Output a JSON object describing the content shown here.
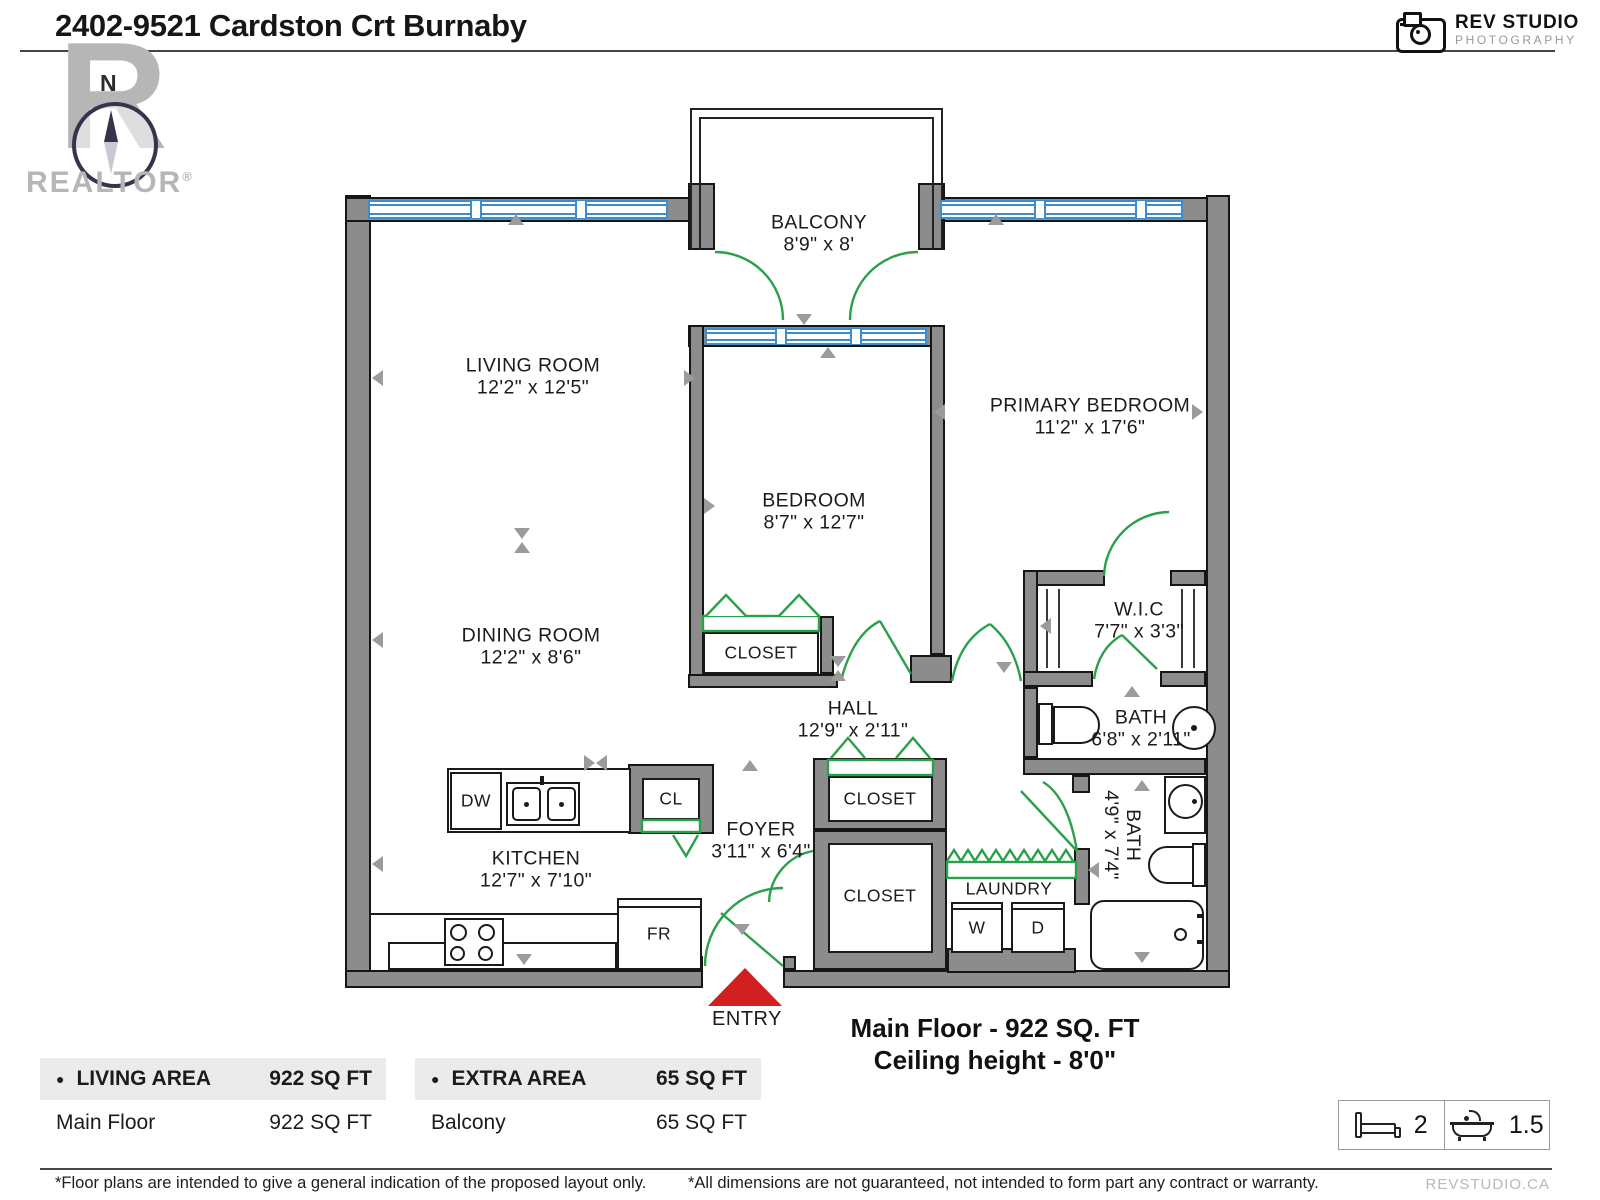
{
  "header": {
    "title": "2402-9521 Cardston Crt Burnaby"
  },
  "branding": {
    "realtor_logo": {
      "letter": "R",
      "compass_n": "N",
      "label": "REALTOR",
      "reg_mark": "®"
    },
    "rev_studio": {
      "name": "REV STUDIO",
      "tagline": "PHOTOGRAPHY"
    },
    "website": "REVSTUDIO.CA"
  },
  "plan": {
    "rooms": [
      {
        "name": "BALCONY",
        "dims": "8'9\" x 8'"
      },
      {
        "name": "LIVING ROOM",
        "dims": "12'2\" x 12'5\""
      },
      {
        "name": "BEDROOM",
        "dims": "8'7\" x 12'7\""
      },
      {
        "name": "PRIMARY BEDROOM",
        "dims": "11'2\" x 17'6\""
      },
      {
        "name": "DINING ROOM",
        "dims": "12'2\" x 8'6\""
      },
      {
        "name": "W.I.C",
        "dims": "7'7\" x 3'3\""
      },
      {
        "name": "BATH",
        "dims": "6'8\" x 2'11\""
      },
      {
        "name": "HALL",
        "dims": "12'9\" x 2'11\""
      },
      {
        "name": "KITCHEN",
        "dims": "12'7\" x 7'10\""
      },
      {
        "name": "FOYER",
        "dims": "3'11\" x 6'4\""
      },
      {
        "name": "BATH",
        "dims": "4'9\" x 7'4\""
      }
    ],
    "labels": {
      "closet": "CLOSET",
      "cl": "CL",
      "laundry": "LAUNDRY",
      "washer": "W",
      "dryer": "D",
      "dishwasher": "DW",
      "fridge": "FR",
      "entry": "ENTRY"
    },
    "summary": {
      "floor": "Main Floor - 922 SQ. FT",
      "ceiling": "Ceiling height - 8'0\""
    }
  },
  "area_tables": [
    {
      "bullet": "●",
      "title": "LIVING AREA",
      "total": "922 SQ FT",
      "rows": [
        {
          "label": "Main Floor",
          "value": "922 SQ FT"
        }
      ]
    },
    {
      "bullet": "●",
      "title": "EXTRA AREA",
      "total": "65 SQ FT",
      "rows": [
        {
          "label": "Balcony",
          "value": "65 SQ FT"
        }
      ]
    }
  ],
  "stats": {
    "beds": "2",
    "baths": "1.5"
  },
  "footnotes": {
    "left": "*Floor plans are intended to give a general indication of the proposed layout only.",
    "right": "*All dimensions are not guaranteed, not intended to form part any contract or warranty."
  },
  "colors": {
    "wall_fill": "#8c8c8c",
    "wall_outline": "#161616",
    "window_blue": "#3f8ccc",
    "door_green": "#2aa04a",
    "entry_red": "#d22020",
    "marker_gray": "#9b9b9b",
    "table_header_bg": "#ebebeb",
    "logo_gray": "#b6b6b6"
  }
}
